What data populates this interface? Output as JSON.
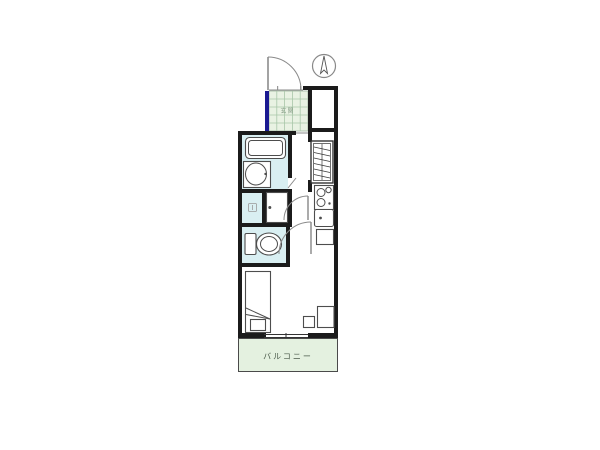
{
  "labels": {
    "balcony": "バルコニー",
    "entrance": "玄関"
  },
  "colors": {
    "background": "#ffffff",
    "wall": "#1b1b1b",
    "line": "#4d4d4d",
    "line_light": "#8a8a8a",
    "wet_area": "#d9eff2",
    "tile": "#e9f2e3",
    "tile_grid": "#a9c6a9",
    "balcony": "#e4f1e0",
    "accent_navy": "#1a1a91",
    "label": "#4a5a4a"
  },
  "icons": {
    "compass": "north-indicator-circle-arrow",
    "entrance_door": "quarter-swing-door",
    "interior_doors": "quarter-swing-door",
    "bathtub": "bathtub",
    "washbasin": "round-washbasin",
    "washing_machine_space": "washer-pan-with-drain",
    "toilet": "toilet-with-tank",
    "closet": "closet-hanger-hatching",
    "stove": "two-burner-stove",
    "kitchen_sink": "kitchen-sink",
    "bed": "single-bed-with-pillow",
    "desk": "desk",
    "chair": "chair",
    "balcony_window": "sliding-window"
  }
}
